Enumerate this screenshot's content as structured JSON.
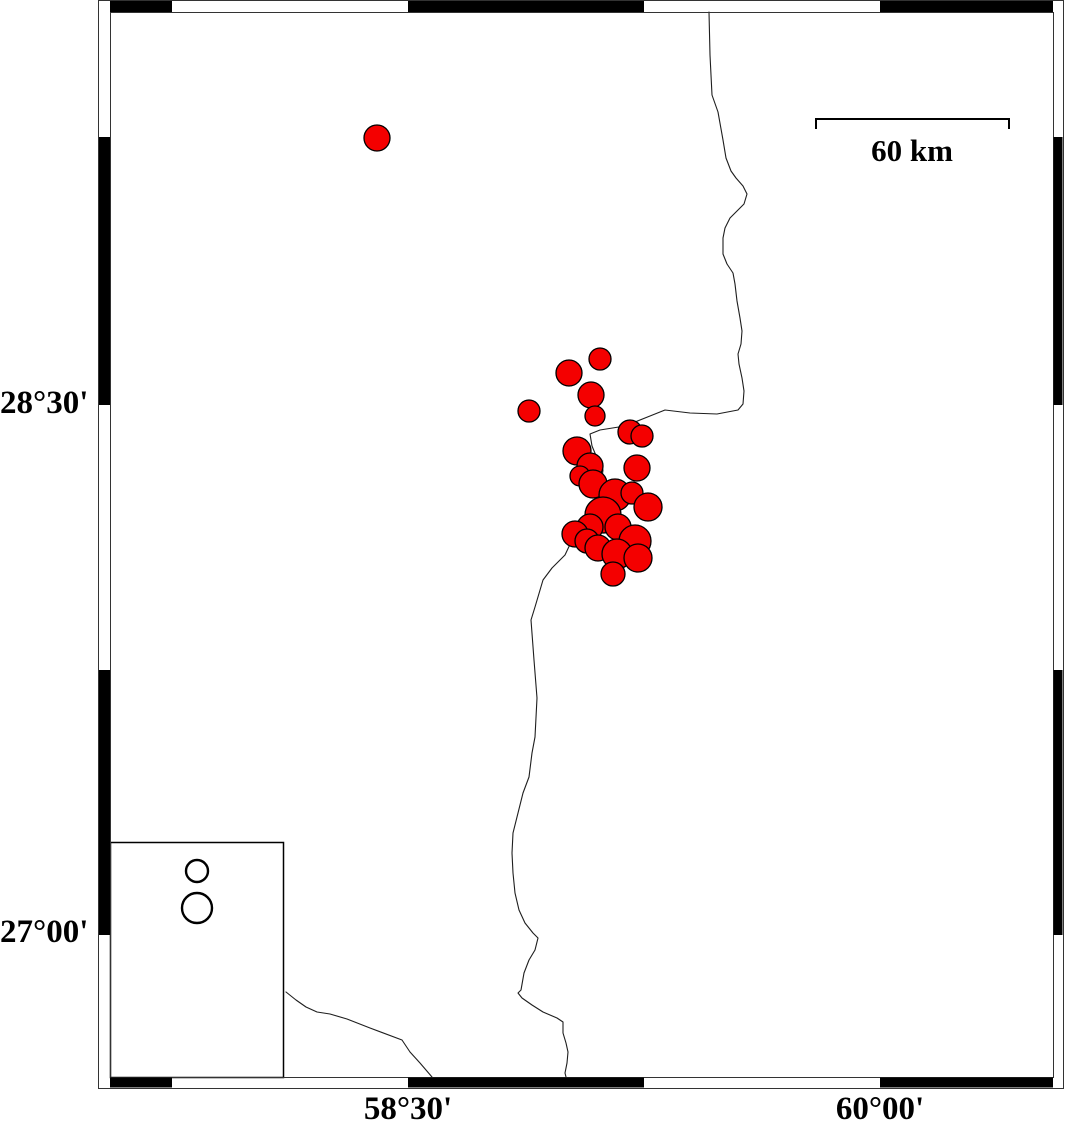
{
  "figure": {
    "title": "seismicity-map",
    "background": "#ffffff",
    "frame": {
      "outer": {
        "x": 98,
        "y": 0,
        "x2": 1063,
        "y2": 1088
      },
      "inner": {
        "x": 110,
        "y": 12,
        "x2": 1053,
        "y2": 1077
      },
      "stroke": "#333333",
      "black_fill": "#000000",
      "top_black_segments": [
        [
          110,
          172
        ],
        [
          408,
          644
        ],
        [
          880,
          1053
        ]
      ],
      "bottom_black_segments": [
        [
          110,
          172
        ],
        [
          408,
          644
        ],
        [
          880,
          1053
        ]
      ],
      "left_black_segments": [
        [
          137,
          405
        ],
        [
          670,
          935
        ]
      ],
      "right_black_segments": [
        [
          137,
          405
        ],
        [
          670,
          935
        ]
      ]
    },
    "axis": {
      "lat_labels": [
        {
          "text": "28°30'",
          "y": 404
        },
        {
          "text": "27°00'",
          "y": 933
        }
      ],
      "lon_labels": [
        {
          "text": "58°30'",
          "x": 408
        },
        {
          "text": "60°00'",
          "x": 880
        }
      ]
    },
    "scale_bar": {
      "label": "60 km",
      "x1": 816,
      "x2": 1009,
      "y": 119,
      "tick_drop": 10,
      "label_cx": 912,
      "label_top": 135
    },
    "legend": {
      "box": {
        "x": 110,
        "y": 842,
        "x2": 283,
        "y2": 1077
      },
      "symbol_fill": "#ffffff",
      "symbol_stroke": "#000000",
      "symbols": [
        {
          "cx": 197,
          "cy": 871,
          "r": 11
        },
        {
          "cx": 197,
          "cy": 908,
          "r": 15
        }
      ]
    },
    "epicenters": {
      "fill": "#f40000",
      "stroke": "#000000",
      "points": [
        [
          377,
          138,
          13
        ],
        [
          600,
          359,
          11
        ],
        [
          569,
          373,
          13
        ],
        [
          591,
          395,
          13
        ],
        [
          529,
          411,
          11
        ],
        [
          595,
          416,
          10
        ],
        [
          630,
          432,
          12
        ],
        [
          642,
          436,
          11
        ],
        [
          577,
          451,
          14
        ],
        [
          590,
          466,
          13
        ],
        [
          580,
          476,
          10
        ],
        [
          593,
          484,
          14
        ],
        [
          637,
          468,
          13
        ],
        [
          615,
          495,
          16
        ],
        [
          632,
          493,
          11
        ],
        [
          648,
          507,
          14
        ],
        [
          603,
          515,
          18
        ],
        [
          590,
          527,
          13
        ],
        [
          575,
          534,
          13
        ],
        [
          618,
          527,
          13
        ],
        [
          635,
          541,
          16
        ],
        [
          587,
          541,
          12
        ],
        [
          598,
          548,
          13
        ],
        [
          617,
          554,
          15
        ],
        [
          638,
          558,
          14
        ],
        [
          613,
          574,
          12
        ]
      ]
    },
    "rivers": {
      "stroke": "#1e1e1e",
      "lines": [
        [
          [
            709,
            12
          ],
          [
            710,
            55
          ],
          [
            712,
            95
          ],
          [
            718,
            112
          ],
          [
            723,
            140
          ],
          [
            726,
            158
          ],
          [
            731,
            171
          ],
          [
            736,
            178
          ],
          [
            743,
            186
          ],
          [
            747,
            194
          ],
          [
            744,
            204
          ],
          [
            737,
            211
          ],
          [
            730,
            218
          ],
          [
            725,
            228
          ],
          [
            723,
            238
          ],
          [
            723,
            254
          ],
          [
            727,
            264
          ],
          [
            733,
            273
          ],
          [
            735,
            284
          ],
          [
            737,
            301
          ],
          [
            740,
            318
          ],
          [
            742,
            331
          ],
          [
            741,
            344
          ],
          [
            738,
            354
          ],
          [
            739,
            364
          ],
          [
            742,
            378
          ],
          [
            744,
            391
          ],
          [
            743,
            404
          ],
          [
            738,
            410
          ],
          [
            717,
            414
          ],
          [
            690,
            413
          ],
          [
            665,
            410
          ],
          [
            650,
            416
          ],
          [
            625,
            426
          ],
          [
            600,
            430
          ],
          [
            590,
            434
          ],
          [
            592,
            446
          ],
          [
            597,
            458
          ],
          [
            603,
            470
          ],
          [
            600,
            492
          ],
          [
            588,
            512
          ],
          [
            578,
            526
          ],
          [
            573,
            538
          ],
          [
            565,
            555
          ],
          [
            552,
            568
          ],
          [
            543,
            580
          ],
          [
            535,
            607
          ],
          [
            531,
            620
          ],
          [
            534,
            660
          ],
          [
            537,
            698
          ],
          [
            535,
            737
          ],
          [
            532,
            753
          ],
          [
            529,
            777
          ],
          [
            523,
            793
          ],
          [
            518,
            813
          ],
          [
            513,
            833
          ],
          [
            512,
            853
          ],
          [
            513,
            873
          ],
          [
            515,
            893
          ],
          [
            519,
            910
          ],
          [
            525,
            923
          ],
          [
            533,
            933
          ],
          [
            538,
            938
          ],
          [
            535,
            950
          ],
          [
            529,
            960
          ],
          [
            524,
            973
          ],
          [
            521,
            990
          ],
          [
            518,
            993
          ],
          [
            522,
            998
          ],
          [
            532,
            1005
          ],
          [
            543,
            1012
          ],
          [
            557,
            1018
          ],
          [
            563,
            1022
          ],
          [
            563,
            1033
          ],
          [
            566,
            1043
          ],
          [
            568,
            1052
          ],
          [
            567,
            1063
          ],
          [
            565,
            1073
          ],
          [
            566,
            1077
          ]
        ],
        [
          [
            286,
            992
          ],
          [
            296,
            1000
          ],
          [
            306,
            1007
          ],
          [
            317,
            1012
          ],
          [
            330,
            1014
          ],
          [
            347,
            1019
          ],
          [
            370,
            1028
          ],
          [
            402,
            1040
          ],
          [
            410,
            1052
          ],
          [
            420,
            1063
          ],
          [
            432,
            1077
          ]
        ]
      ]
    }
  }
}
